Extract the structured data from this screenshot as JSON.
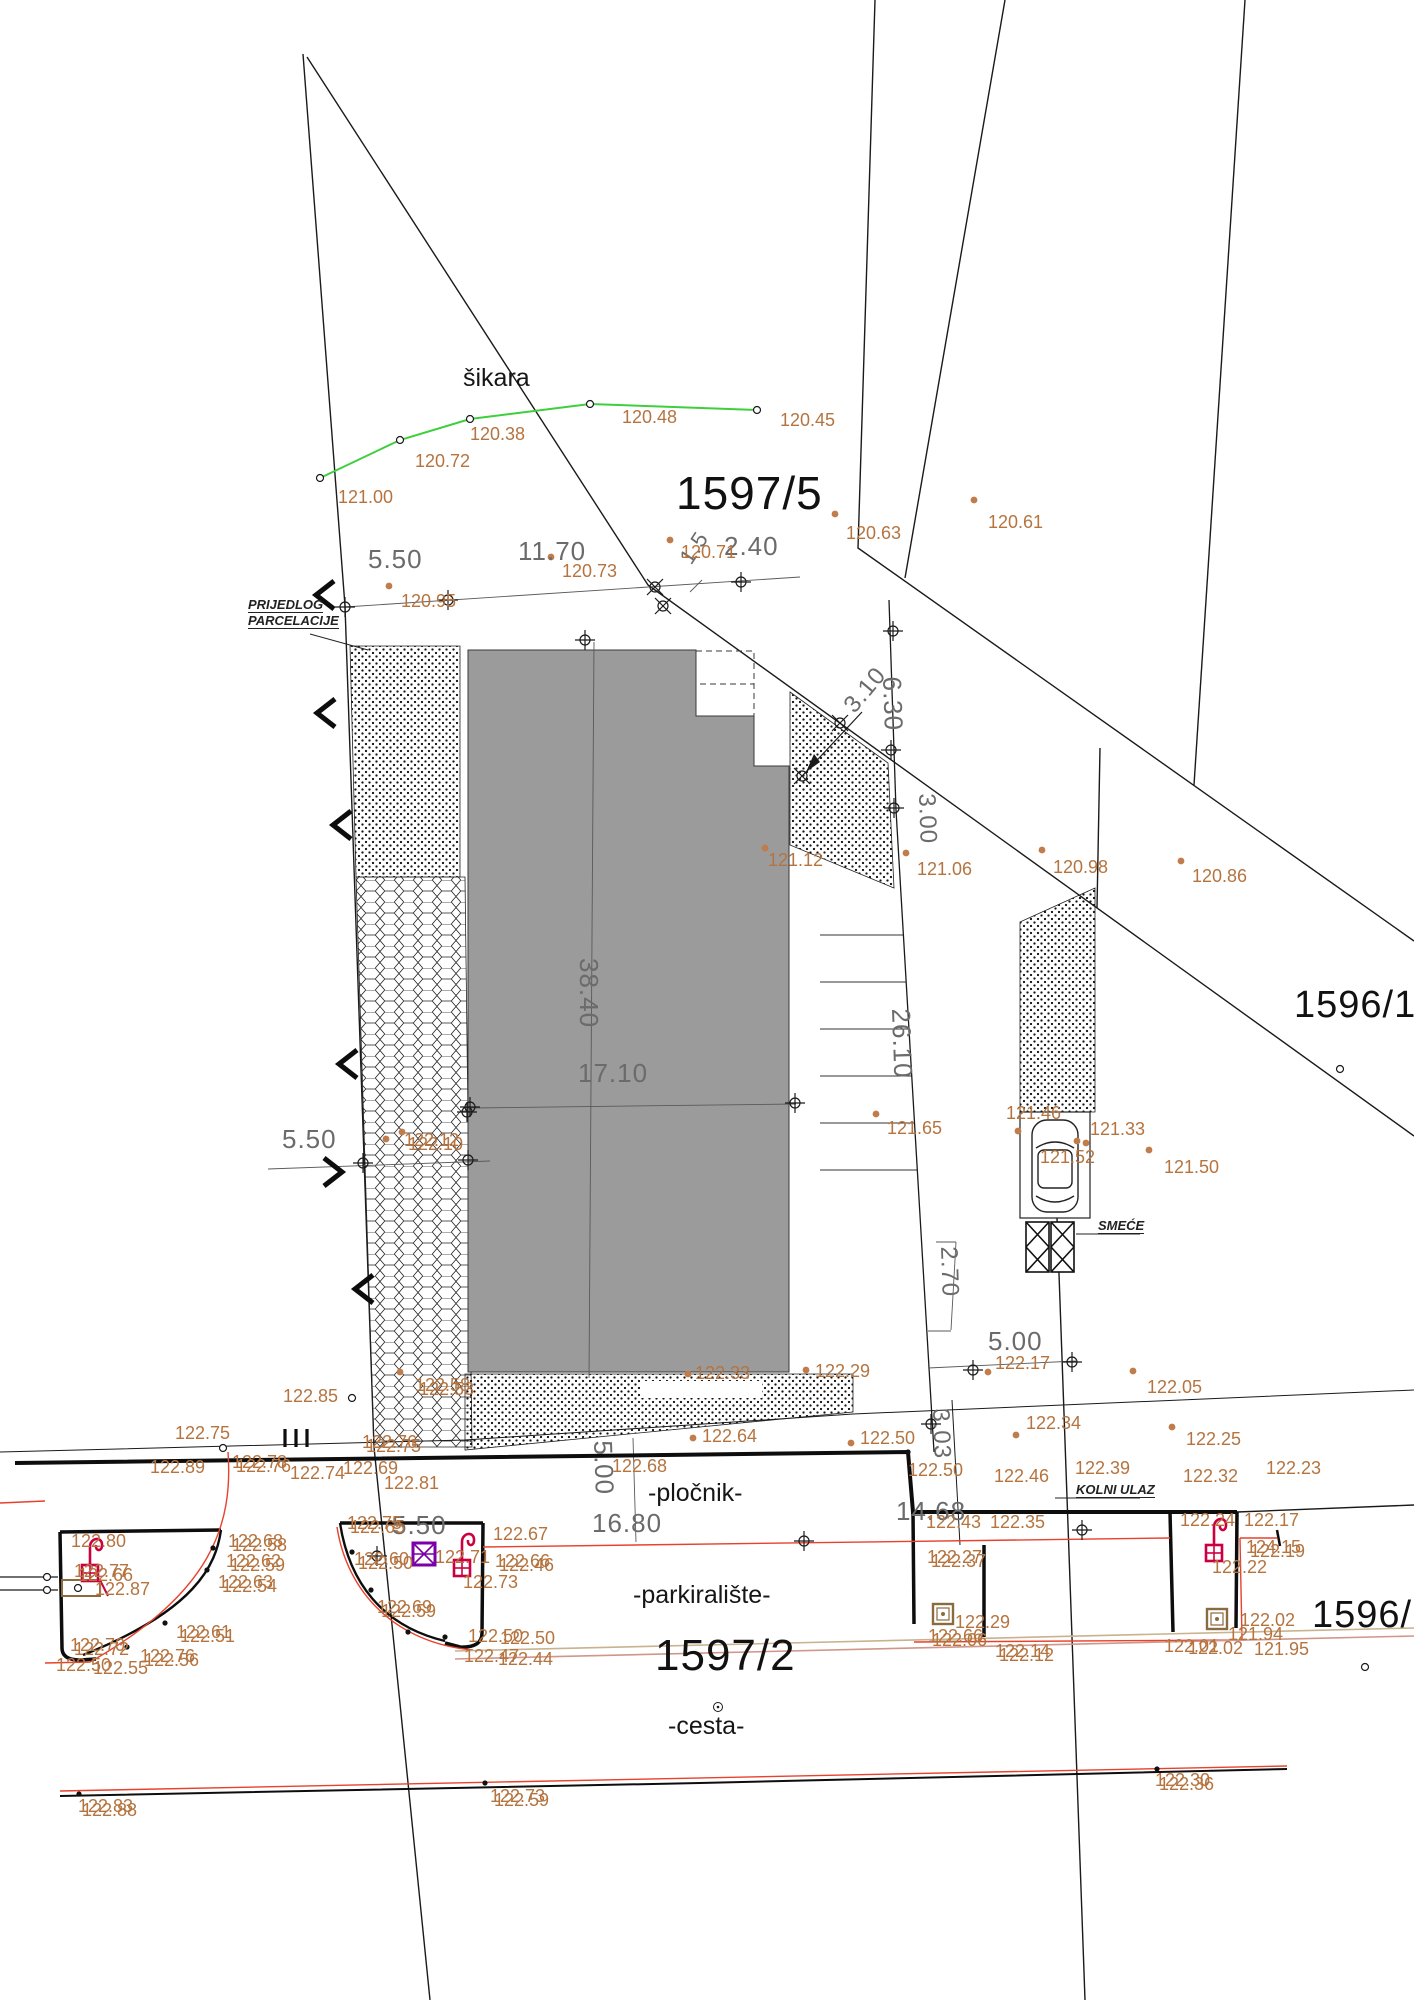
{
  "drawing_title": "geodetic site plan (prijedlog parcelacije)",
  "colors": {
    "elevation_text": "#b5743f",
    "dimension_text": "#6b6b6b",
    "line": "#1a1a1a",
    "building_fill": "#9b9b9b",
    "green_boundary": "#3ecf3e",
    "curb_red": "#e8412c",
    "symbol_red": "#cc0040",
    "symbol_purple": "#7b00a8",
    "tan": "#b89a6e"
  },
  "parcel_labels": [
    {
      "t": "1597/5",
      "x": 676,
      "y": 470,
      "fs": 46
    },
    {
      "t": "1596/1",
      "x": 1294,
      "y": 986,
      "fs": 38
    },
    {
      "t": "1597/2",
      "x": 655,
      "y": 1634,
      "fs": 44
    },
    {
      "t": "1596/2",
      "x": 1312,
      "y": 1596,
      "fs": 38
    }
  ],
  "area_labels": [
    {
      "t": "šikara",
      "x": 463,
      "y": 366
    },
    {
      "t": "-pločnik-",
      "x": 648,
      "y": 1481
    },
    {
      "t": "-parkiralište-",
      "x": 633,
      "y": 1583
    },
    {
      "t": "-cesta-",
      "x": 668,
      "y": 1714
    }
  ],
  "note_labels": [
    {
      "t": "PRIJEDLOG",
      "x": 248,
      "y": 598
    },
    {
      "t": "PARCELACIJE",
      "x": 248,
      "y": 614
    },
    {
      "t": "SMEĆE",
      "x": 1098,
      "y": 1219
    },
    {
      "t": "KOLNI ULAZ",
      "x": 1076,
      "y": 1483
    }
  ],
  "dim_labels": [
    {
      "t": "5.50",
      "x": 368,
      "y": 546
    },
    {
      "t": "11.70",
      "x": 518,
      "y": 538
    },
    {
      "t": "1.5",
      "x": 676,
      "y": 556,
      "r": -57,
      "fs": 22
    },
    {
      "t": "2.40",
      "x": 724,
      "y": 533
    },
    {
      "t": "3.10",
      "x": 840,
      "y": 702,
      "r": -50,
      "fs": 24
    },
    {
      "t": "6.30",
      "x": 905,
      "y": 676,
      "r": 88
    },
    {
      "t": "3.00",
      "x": 938,
      "y": 793,
      "r": 88,
      "fs": 24
    },
    {
      "t": "38.40",
      "x": 602,
      "y": 958,
      "r": 90
    },
    {
      "t": "17.10",
      "x": 578,
      "y": 1060
    },
    {
      "t": "26.10",
      "x": 914,
      "y": 1008,
      "r": 88
    },
    {
      "t": "5.50",
      "x": 282,
      "y": 1126
    },
    {
      "t": "2.70",
      "x": 960,
      "y": 1246,
      "r": 88,
      "fs": 24
    },
    {
      "t": "5.00",
      "x": 988,
      "y": 1328
    },
    {
      "t": "3.03",
      "x": 952,
      "y": 1408,
      "r": 88,
      "fs": 24
    },
    {
      "t": "5.00",
      "x": 616,
      "y": 1440,
      "r": 88
    },
    {
      "t": "16.80",
      "x": 592,
      "y": 1510
    },
    {
      "t": "14.68",
      "x": 896,
      "y": 1498
    },
    {
      "t": "5.50",
      "x": 392,
      "y": 1512
    }
  ],
  "elevation_labels": [
    {
      "t": "121.00",
      "x": 338,
      "y": 488
    },
    {
      "t": "120.72",
      "x": 415,
      "y": 452
    },
    {
      "t": "120.38",
      "x": 470,
      "y": 425
    },
    {
      "t": "120.48",
      "x": 622,
      "y": 408
    },
    {
      "t": "120.45",
      "x": 780,
      "y": 411
    },
    {
      "t": "120.63",
      "x": 846,
      "y": 524
    },
    {
      "t": "120.61",
      "x": 988,
      "y": 513
    },
    {
      "t": "120.95",
      "x": 401,
      "y": 592
    },
    {
      "t": "120.73",
      "x": 562,
      "y": 562
    },
    {
      "t": "120.71",
      "x": 681,
      "y": 543
    },
    {
      "t": "121.12",
      "x": 768,
      "y": 851
    },
    {
      "t": "121.06",
      "x": 917,
      "y": 860
    },
    {
      "t": "120.98",
      "x": 1053,
      "y": 858
    },
    {
      "t": "120.86",
      "x": 1192,
      "y": 867
    },
    {
      "t": "121.65",
      "x": 887,
      "y": 1119
    },
    {
      "t": "121.46",
      "x": 1006,
      "y": 1104
    },
    {
      "t": "121.33",
      "x": 1090,
      "y": 1120
    },
    {
      "t": "121.52",
      "x": 1040,
      "y": 1148
    },
    {
      "t": "121.50",
      "x": 1164,
      "y": 1158
    },
    {
      "t": "122.85",
      "x": 283,
      "y": 1387
    },
    {
      "t": "122.58",
      "x": 415,
      "y": 1376
    },
    {
      "t": "122.53",
      "x": 419,
      "y": 1380
    },
    {
      "t": "122.33",
      "x": 695,
      "y": 1364
    },
    {
      "t": "122.29",
      "x": 815,
      "y": 1362
    },
    {
      "t": "122.17",
      "x": 995,
      "y": 1354
    },
    {
      "t": "122.05",
      "x": 1147,
      "y": 1378
    },
    {
      "t": "122.34",
      "x": 1026,
      "y": 1414
    },
    {
      "t": "122.25",
      "x": 1186,
      "y": 1430
    },
    {
      "t": "122.64",
      "x": 702,
      "y": 1427
    },
    {
      "t": "122.50",
      "x": 860,
      "y": 1429
    },
    {
      "t": "122.50",
      "x": 908,
      "y": 1461
    },
    {
      "t": "122.46",
      "x": 994,
      "y": 1467
    },
    {
      "t": "122.39",
      "x": 1075,
      "y": 1459
    },
    {
      "t": "122.32",
      "x": 1183,
      "y": 1467
    },
    {
      "t": "122.23",
      "x": 1266,
      "y": 1459
    },
    {
      "t": "122.75",
      "x": 175,
      "y": 1424
    },
    {
      "t": "122.89",
      "x": 150,
      "y": 1458
    },
    {
      "t": "122.78",
      "x": 232,
      "y": 1453
    },
    {
      "t": "122.76",
      "x": 236,
      "y": 1457
    },
    {
      "t": "122.74",
      "x": 290,
      "y": 1464
    },
    {
      "t": "122.69",
      "x": 343,
      "y": 1459
    },
    {
      "t": "122.76",
      "x": 362,
      "y": 1433
    },
    {
      "t": "122.75",
      "x": 366,
      "y": 1437
    },
    {
      "t": "122.81",
      "x": 384,
      "y": 1474
    },
    {
      "t": "122.68",
      "x": 612,
      "y": 1457
    },
    {
      "t": "122.80",
      "x": 71,
      "y": 1532
    },
    {
      "t": "122.77",
      "x": 74,
      "y": 1562
    },
    {
      "t": "122.66",
      "x": 78,
      "y": 1566
    },
    {
      "t": "122.87",
      "x": 95,
      "y": 1580
    },
    {
      "t": "122.68",
      "x": 228,
      "y": 1532
    },
    {
      "t": "122.58",
      "x": 232,
      "y": 1536
    },
    {
      "t": "122.62",
      "x": 226,
      "y": 1552
    },
    {
      "t": "122.59",
      "x": 230,
      "y": 1556
    },
    {
      "t": "122.63",
      "x": 218,
      "y": 1573
    },
    {
      "t": "122.54",
      "x": 222,
      "y": 1577
    },
    {
      "t": "122.61",
      "x": 176,
      "y": 1623
    },
    {
      "t": "122.51",
      "x": 180,
      "y": 1627
    },
    {
      "t": "122.70",
      "x": 70,
      "y": 1636
    },
    {
      "t": "122.72",
      "x": 74,
      "y": 1640
    },
    {
      "t": "122.76",
      "x": 140,
      "y": 1647
    },
    {
      "t": "122.56",
      "x": 144,
      "y": 1651
    },
    {
      "t": "122.50",
      "x": 56,
      "y": 1656
    },
    {
      "t": "122.55",
      "x": 93,
      "y": 1659
    },
    {
      "t": "122.75",
      "x": 347,
      "y": 1514
    },
    {
      "t": "122.65",
      "x": 350,
      "y": 1518
    },
    {
      "t": "122.60",
      "x": 354,
      "y": 1550
    },
    {
      "t": "122.50",
      "x": 358,
      "y": 1554
    },
    {
      "t": "122.67",
      "x": 493,
      "y": 1525
    },
    {
      "t": "122.71",
      "x": 435,
      "y": 1548
    },
    {
      "t": "122.66",
      "x": 495,
      "y": 1552
    },
    {
      "t": "122.46",
      "x": 499,
      "y": 1556
    },
    {
      "t": "122.73",
      "x": 463,
      "y": 1573
    },
    {
      "t": "122.69",
      "x": 377,
      "y": 1598
    },
    {
      "t": "122.59",
      "x": 381,
      "y": 1602
    },
    {
      "t": "122.50",
      "x": 468,
      "y": 1627
    },
    {
      "t": "122.50",
      "x": 500,
      "y": 1629
    },
    {
      "t": "122.47",
      "x": 464,
      "y": 1647
    },
    {
      "t": "122.44",
      "x": 498,
      "y": 1650
    },
    {
      "t": "122.43",
      "x": 926,
      "y": 1513
    },
    {
      "t": "122.35",
      "x": 990,
      "y": 1513
    },
    {
      "t": "122.27",
      "x": 927,
      "y": 1548
    },
    {
      "t": "122.37",
      "x": 931,
      "y": 1552
    },
    {
      "t": "122.24",
      "x": 1180,
      "y": 1511
    },
    {
      "t": "122.17",
      "x": 1244,
      "y": 1511
    },
    {
      "t": "124.15",
      "x": 1246,
      "y": 1538
    },
    {
      "t": "122.19",
      "x": 1250,
      "y": 1542
    },
    {
      "t": "122.22",
      "x": 1212,
      "y": 1558
    },
    {
      "t": "122.29",
      "x": 955,
      "y": 1613
    },
    {
      "t": "122.66",
      "x": 928,
      "y": 1627
    },
    {
      "t": "122.06",
      "x": 932,
      "y": 1631
    },
    {
      "t": "122.14",
      "x": 995,
      "y": 1642
    },
    {
      "t": "122.12",
      "x": 999,
      "y": 1646
    },
    {
      "t": "122.01",
      "x": 1164,
      "y": 1637
    },
    {
      "t": "122.02",
      "x": 1188,
      "y": 1639
    },
    {
      "t": "121.94",
      "x": 1228,
      "y": 1625
    },
    {
      "t": "122.02",
      "x": 1240,
      "y": 1611
    },
    {
      "t": "121.95",
      "x": 1254,
      "y": 1640
    },
    {
      "t": "122.83",
      "x": 78,
      "y": 1797
    },
    {
      "t": "122.88",
      "x": 82,
      "y": 1801
    },
    {
      "t": "122.73",
      "x": 490,
      "y": 1787
    },
    {
      "t": "122.59",
      "x": 494,
      "y": 1791
    },
    {
      "t": "122.30",
      "x": 1155,
      "y": 1771
    },
    {
      "t": "122.36",
      "x": 1159,
      "y": 1775
    },
    {
      "t": "122.12",
      "x": 404,
      "y": 1131
    },
    {
      "t": "122.10",
      "x": 408,
      "y": 1135
    }
  ],
  "orange_dots": [
    [
      835,
      514
    ],
    [
      974,
      500
    ],
    [
      389,
      586
    ],
    [
      551,
      557
    ],
    [
      670,
      540
    ],
    [
      765,
      848
    ],
    [
      906,
      853
    ],
    [
      1042,
      850
    ],
    [
      1181,
      861
    ],
    [
      876,
      1114
    ],
    [
      1018,
      1131
    ],
    [
      1077,
      1141
    ],
    [
      1086,
      1143
    ],
    [
      1149,
      1150
    ],
    [
      400,
      1372
    ],
    [
      688,
      1374
    ],
    [
      806,
      1370
    ],
    [
      988,
      1372
    ],
    [
      1133,
      1371
    ],
    [
      1016,
      1435
    ],
    [
      1172,
      1427
    ],
    [
      693,
      1438
    ],
    [
      851,
      1443
    ],
    [
      386,
      1139
    ],
    [
      402,
      1132
    ]
  ],
  "black_dots": [
    [
      79,
      1794
    ],
    [
      485,
      1783
    ],
    [
      1157,
      1769
    ],
    [
      213,
      1548
    ],
    [
      207,
      1570
    ],
    [
      165,
      1623
    ],
    [
      127,
      1647
    ],
    [
      352,
      1552
    ],
    [
      371,
      1590
    ],
    [
      408,
      1632
    ],
    [
      445,
      1637
    ],
    [
      223,
      1448
    ],
    [
      908,
      1452
    ]
  ],
  "open_circles": [
    [
      320,
      478
    ],
    [
      400,
      440
    ],
    [
      470,
      419
    ],
    [
      590,
      404
    ],
    [
      757,
      410
    ],
    [
      223,
      1448
    ],
    [
      352,
      1398
    ],
    [
      1340,
      1069
    ],
    [
      1365,
      1667
    ],
    [
      47,
      1577
    ],
    [
      47,
      1590
    ]
  ],
  "double_circles": [
    [
      718,
      1707
    ]
  ],
  "cross_circle_markers": [
    [
      345,
      607
    ],
    [
      448,
      600
    ],
    [
      741,
      582
    ],
    [
      585,
      640
    ],
    [
      893,
      631
    ],
    [
      891,
      750
    ],
    [
      894,
      808
    ],
    [
      795,
      1103
    ],
    [
      470,
      1107
    ],
    [
      467,
      1112
    ],
    [
      468,
      1160
    ],
    [
      363,
      1163
    ],
    [
      973,
      1370
    ],
    [
      1072,
      1362
    ],
    [
      804,
      1541
    ],
    [
      931,
      1424
    ],
    [
      1082,
      1530
    ],
    [
      377,
      1556
    ]
  ],
  "x_circle_markers": [
    [
      655,
      587
    ],
    [
      663,
      606
    ],
    [
      840,
      723
    ],
    [
      802,
      776
    ]
  ],
  "chevrons": [
    {
      "x": 325,
      "y": 595,
      "d": "l"
    },
    {
      "x": 326,
      "y": 713,
      "d": "l"
    },
    {
      "x": 342,
      "y": 825,
      "d": "l"
    },
    {
      "x": 348,
      "y": 1064,
      "d": "l"
    },
    {
      "x": 333,
      "y": 1172,
      "d": "r"
    },
    {
      "x": 364,
      "y": 1289,
      "d": "l"
    }
  ],
  "lamps": [
    {
      "x": 90,
      "y": 1545
    },
    {
      "x": 462,
      "y": 1540
    },
    {
      "x": 1214,
      "y": 1525
    }
  ],
  "purple_boxes": [
    {
      "x": 413,
      "y": 1543
    }
  ],
  "manholes": [
    {
      "x": 933,
      "y": 1604
    },
    {
      "x": 1207,
      "y": 1609
    }
  ]
}
